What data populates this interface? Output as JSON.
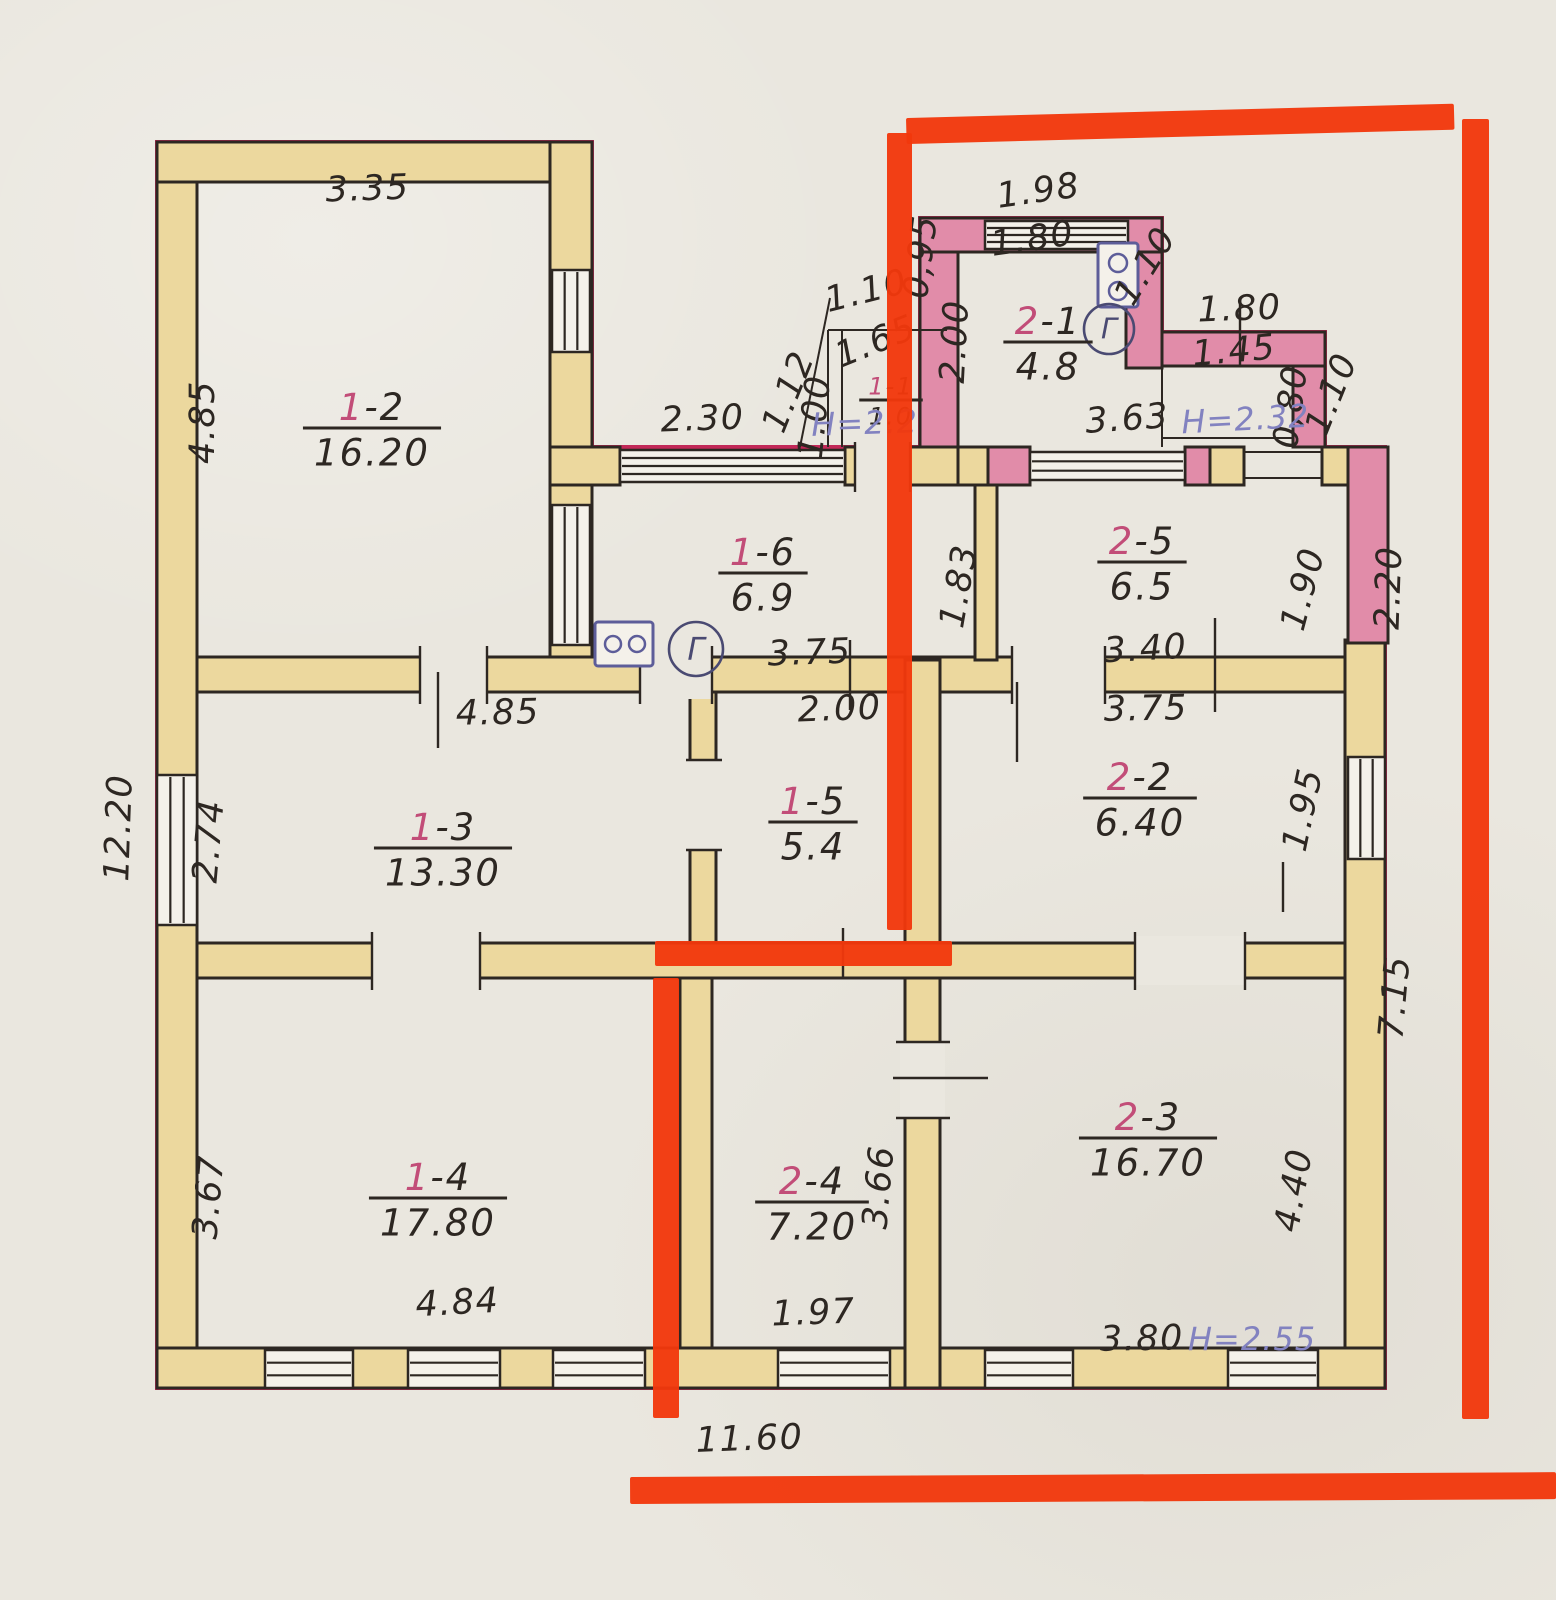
{
  "document": {
    "type": "hand-drawn floor plan (technical passport sheet)",
    "height_notes_color": "#8282c0",
    "marker_color": "#f1380c"
  },
  "palette": {
    "paper": "#eae7df",
    "wall_tan": "#ecd89e",
    "wall_pink": "#e18ca9",
    "ink": "#2d2722",
    "crimson": "#c22858",
    "marker": "#f1380c",
    "purple": "#8282c0",
    "blue": "#5d5d99",
    "meter_ink": "#4a4a72",
    "room_num_red": "#c24d78",
    "white": "#f4f1ea"
  },
  "rooms": [
    {
      "num": "1-2",
      "area": "16.20",
      "x": 372,
      "y": 428
    },
    {
      "num": "1-6",
      "area": "6.9",
      "x": 763,
      "y": 573
    },
    {
      "num": "2-1",
      "area": "4.8",
      "x": 1048,
      "y": 342
    },
    {
      "num": "2-5",
      "area": "6.5",
      "x": 1142,
      "y": 562
    },
    {
      "num": "1-3",
      "area": "13.30",
      "x": 443,
      "y": 848
    },
    {
      "num": "1-5",
      "area": "5.4",
      "x": 813,
      "y": 822
    },
    {
      "num": "2-2",
      "area": "6.40",
      "x": 1140,
      "y": 798
    },
    {
      "num": "1-4",
      "area": "17.80",
      "x": 438,
      "y": 1198
    },
    {
      "num": "2-4",
      "area": "7.20",
      "x": 812,
      "y": 1202
    },
    {
      "num": "2-3",
      "area": "16.70",
      "x": 1148,
      "y": 1138
    },
    {
      "num": "1-1",
      "area": "1.0",
      "x": 891,
      "y": 400,
      "s": 24
    }
  ],
  "dims": [
    {
      "t": "3.35",
      "x": 368,
      "y": 200,
      "r": -2
    },
    {
      "t": "4.85",
      "x": 214,
      "y": 422,
      "r": -90
    },
    {
      "t": "2.30",
      "x": 703,
      "y": 430,
      "r": -2
    },
    {
      "t": "1.98",
      "x": 1040,
      "y": 202,
      "r": -8
    },
    {
      "t": "1.80",
      "x": 1034,
      "y": 250,
      "r": -8
    },
    {
      "t": "0,95",
      "x": 932,
      "y": 258,
      "r": -83
    },
    {
      "t": "2.00",
      "x": 966,
      "y": 342,
      "r": -87
    },
    {
      "t": "1.10",
      "x": 1155,
      "y": 272,
      "r": -58
    },
    {
      "t": "1.80",
      "x": 1240,
      "y": 320,
      "r": -2
    },
    {
      "t": "1.45",
      "x": 1235,
      "y": 362,
      "r": -5
    },
    {
      "t": "0,80",
      "x": 1302,
      "y": 408,
      "r": -83
    },
    {
      "t": "1.10",
      "x": 1342,
      "y": 398,
      "r": -68
    },
    {
      "t": "3.63",
      "x": 1128,
      "y": 430,
      "r": -4
    },
    {
      "t": "1.12",
      "x": 799,
      "y": 396,
      "r": -68
    },
    {
      "t": "1.00",
      "x": 826,
      "y": 418,
      "r": -84
    },
    {
      "t": "1.65",
      "x": 880,
      "y": 352,
      "r": -22
    },
    {
      "t": "1.10",
      "x": 869,
      "y": 302,
      "r": -14
    },
    {
      "t": "1.83",
      "x": 970,
      "y": 588,
      "r": -80
    },
    {
      "t": "1.90",
      "x": 1314,
      "y": 592,
      "r": -75
    },
    {
      "t": "2.20",
      "x": 1400,
      "y": 588,
      "r": -88
    },
    {
      "t": "3.40",
      "x": 1146,
      "y": 660,
      "r": -3
    },
    {
      "t": "3.75",
      "x": 810,
      "y": 664,
      "r": -2
    },
    {
      "t": "12.20",
      "x": 130,
      "y": 828,
      "r": -88
    },
    {
      "t": "2.74",
      "x": 220,
      "y": 842,
      "r": -85
    },
    {
      "t": "4.85",
      "x": 498,
      "y": 724,
      "r": -1
    },
    {
      "t": "2.00",
      "x": 840,
      "y": 720,
      "r": -2
    },
    {
      "t": "3.75",
      "x": 1146,
      "y": 720,
      "r": -1
    },
    {
      "t": "1.95",
      "x": 1314,
      "y": 812,
      "r": -78
    },
    {
      "t": "3.67",
      "x": 220,
      "y": 1198,
      "r": -85
    },
    {
      "t": "3.66",
      "x": 890,
      "y": 1188,
      "r": -85
    },
    {
      "t": "4.40",
      "x": 1305,
      "y": 1192,
      "r": -80
    },
    {
      "t": "7.15",
      "x": 1406,
      "y": 998,
      "r": -85
    },
    {
      "t": "4.84",
      "x": 458,
      "y": 1314,
      "r": -3
    },
    {
      "t": "1.97",
      "x": 814,
      "y": 1324,
      "r": -2
    },
    {
      "t": "3.80",
      "x": 1142,
      "y": 1350,
      "r": -1
    },
    {
      "t": "11.60",
      "x": 750,
      "y": 1450,
      "r": -2
    }
  ],
  "notes": [
    {
      "t": "Н=2.2",
      "x": 865,
      "y": 434,
      "r": -2
    },
    {
      "t": "Н=2.32",
      "x": 1246,
      "y": 430,
      "r": -3
    },
    {
      "t": "Н=2.55",
      "x": 1252,
      "y": 1350,
      "r": 0
    }
  ],
  "marker_segments": [
    {
      "x": 906,
      "y": 118,
      "w": 548,
      "h": 26,
      "rot": -1.5
    },
    {
      "x": 1462,
      "y": 119,
      "w": 27,
      "h": 1300,
      "rot": 0
    },
    {
      "x": 887,
      "y": 133,
      "w": 25,
      "h": 797,
      "rot": 0
    },
    {
      "x": 655,
      "y": 941,
      "w": 297,
      "h": 25,
      "rot": 0
    },
    {
      "x": 653,
      "y": 978,
      "w": 26,
      "h": 440,
      "rot": 0
    },
    {
      "x": 630,
      "y": 1477,
      "w": 926,
      "h": 27,
      "rot": -0.3
    }
  ],
  "geometry": {
    "outline": "M157 1388 L157 142 L592 142 L592 447 L920 447 L920 218 L1162 218 L1162 332 L1325 332 L1325 447 L1385 447 L1385 1388 Z",
    "walls": [
      {
        "x": 157,
        "y": 142,
        "w": 40,
        "h": 1246,
        "f": "t"
      },
      {
        "x": 157,
        "y": 142,
        "w": 435,
        "h": 40,
        "f": "t"
      },
      {
        "x": 550,
        "y": 142,
        "w": 42,
        "h": 548,
        "f": "t"
      },
      {
        "x": 550,
        "y": 447,
        "w": 70,
        "h": 38,
        "f": "t"
      },
      {
        "x": 845,
        "y": 447,
        "w": 113,
        "h": 38,
        "f": "t"
      },
      {
        "x": 958,
        "y": 447,
        "w": 30,
        "h": 38,
        "f": "t"
      },
      {
        "x": 988,
        "y": 447,
        "w": 42,
        "h": 38,
        "f": "p"
      },
      {
        "x": 1185,
        "y": 447,
        "w": 25,
        "h": 38,
        "f": "p"
      },
      {
        "x": 1210,
        "y": 447,
        "w": 34,
        "h": 38,
        "f": "t"
      },
      {
        "x": 1322,
        "y": 447,
        "w": 63,
        "h": 38,
        "f": "t"
      },
      {
        "x": 1345,
        "y": 640,
        "w": 40,
        "h": 748,
        "f": "t"
      },
      {
        "x": 1348,
        "y": 447,
        "w": 40,
        "h": 196,
        "f": "p"
      },
      {
        "x": 157,
        "y": 1348,
        "w": 1228,
        "h": 40,
        "f": "t"
      },
      {
        "x": 197,
        "y": 657,
        "w": 1148,
        "h": 35,
        "f": "t"
      },
      {
        "x": 975,
        "y": 485,
        "w": 22,
        "h": 175,
        "f": "t"
      },
      {
        "x": 690,
        "y": 692,
        "w": 26,
        "h": 253,
        "f": "t"
      },
      {
        "x": 905,
        "y": 660,
        "w": 35,
        "h": 728,
        "f": "t"
      },
      {
        "x": 680,
        "y": 975,
        "w": 32,
        "h": 373,
        "f": "t"
      },
      {
        "x": 197,
        "y": 943,
        "w": 1148,
        "h": 35,
        "f": "t"
      },
      {
        "x": 920,
        "y": 218,
        "w": 38,
        "h": 229,
        "f": "p"
      },
      {
        "x": 920,
        "y": 218,
        "w": 242,
        "h": 34,
        "f": "p"
      },
      {
        "x": 1126,
        "y": 252,
        "w": 36,
        "h": 116,
        "f": "p"
      },
      {
        "x": 1162,
        "y": 332,
        "w": 163,
        "h": 34,
        "f": "p"
      },
      {
        "x": 1293,
        "y": 366,
        "w": 32,
        "h": 81,
        "f": "p"
      }
    ],
    "gap_covers": [
      {
        "x": 420,
        "y": 650,
        "w": 67,
        "h": 49
      },
      {
        "x": 640,
        "y": 650,
        "w": 72,
        "h": 49
      },
      {
        "x": 1012,
        "y": 650,
        "w": 93,
        "h": 49
      },
      {
        "x": 372,
        "y": 936,
        "w": 108,
        "h": 49
      },
      {
        "x": 1135,
        "y": 936,
        "w": 110,
        "h": 49
      },
      {
        "x": 900,
        "y": 1042,
        "w": 45,
        "h": 76
      },
      {
        "x": 683,
        "y": 760,
        "w": 40,
        "h": 90
      },
      {
        "x": 855,
        "y": 440,
        "w": 55,
        "h": 52
      }
    ],
    "windows": [
      {
        "x": 157,
        "y": 775,
        "w": 40,
        "h": 150,
        "dir": "v",
        "n": 2
      },
      {
        "x": 552,
        "y": 270,
        "w": 38,
        "h": 82,
        "dir": "v",
        "n": 2
      },
      {
        "x": 552,
        "y": 505,
        "w": 38,
        "h": 140,
        "dir": "v",
        "n": 2
      },
      {
        "x": 620,
        "y": 450,
        "w": 225,
        "h": 32,
        "dir": "h",
        "n": 3
      },
      {
        "x": 985,
        "y": 221,
        "w": 143,
        "h": 28,
        "dir": "h",
        "n": 3
      },
      {
        "x": 1030,
        "y": 452,
        "w": 155,
        "h": 28,
        "dir": "h",
        "n": 2
      },
      {
        "x": 1348,
        "y": 757,
        "w": 37,
        "h": 102,
        "dir": "v",
        "n": 2
      },
      {
        "x": 265,
        "y": 1350,
        "w": 88,
        "h": 38,
        "dir": "h",
        "n": 2
      },
      {
        "x": 408,
        "y": 1350,
        "w": 92,
        "h": 38,
        "dir": "h",
        "n": 2
      },
      {
        "x": 553,
        "y": 1350,
        "w": 92,
        "h": 38,
        "dir": "h",
        "n": 2
      },
      {
        "x": 778,
        "y": 1350,
        "w": 112,
        "h": 38,
        "dir": "h",
        "n": 2
      },
      {
        "x": 985,
        "y": 1350,
        "w": 88,
        "h": 38,
        "dir": "h",
        "n": 2
      },
      {
        "x": 1228,
        "y": 1350,
        "w": 90,
        "h": 38,
        "dir": "h",
        "n": 2
      }
    ],
    "thin_lines": [
      {
        "x1": 828,
        "y1": 330,
        "x2": 828,
        "y2": 447
      },
      {
        "x1": 842,
        "y1": 330,
        "x2": 842,
        "y2": 447
      },
      {
        "x1": 828,
        "y1": 330,
        "x2": 947,
        "y2": 330
      },
      {
        "x1": 800,
        "y1": 447,
        "x2": 830,
        "y2": 298
      },
      {
        "x1": 1162,
        "y1": 368,
        "x2": 1162,
        "y2": 447
      },
      {
        "x1": 1162,
        "y1": 438,
        "x2": 1293,
        "y2": 438
      },
      {
        "x1": 1244,
        "y1": 452,
        "x2": 1322,
        "y2": 452
      },
      {
        "x1": 1244,
        "y1": 478,
        "x2": 1322,
        "y2": 478
      }
    ],
    "ticks": [
      {
        "x1": 420,
        "y1": 646,
        "x2": 420,
        "y2": 704
      },
      {
        "x1": 487,
        "y1": 646,
        "x2": 487,
        "y2": 704
      },
      {
        "x1": 640,
        "y1": 646,
        "x2": 640,
        "y2": 704
      },
      {
        "x1": 712,
        "y1": 646,
        "x2": 712,
        "y2": 704
      },
      {
        "x1": 1012,
        "y1": 646,
        "x2": 1012,
        "y2": 704
      },
      {
        "x1": 1105,
        "y1": 646,
        "x2": 1105,
        "y2": 704
      },
      {
        "x1": 372,
        "y1": 932,
        "x2": 372,
        "y2": 990
      },
      {
        "x1": 480,
        "y1": 932,
        "x2": 480,
        "y2": 990
      },
      {
        "x1": 1135,
        "y1": 932,
        "x2": 1135,
        "y2": 990
      },
      {
        "x1": 1245,
        "y1": 932,
        "x2": 1245,
        "y2": 990
      },
      {
        "x1": 896,
        "y1": 1042,
        "x2": 950,
        "y2": 1042
      },
      {
        "x1": 896,
        "y1": 1118,
        "x2": 950,
        "y2": 1118
      },
      {
        "x1": 893,
        "y1": 1078,
        "x2": 988,
        "y2": 1078
      },
      {
        "x1": 686,
        "y1": 760,
        "x2": 722,
        "y2": 760
      },
      {
        "x1": 686,
        "y1": 850,
        "x2": 722,
        "y2": 850
      },
      {
        "x1": 855,
        "y1": 442,
        "x2": 855,
        "y2": 492
      },
      {
        "x1": 910,
        "y1": 442,
        "x2": 910,
        "y2": 492
      },
      {
        "x1": 438,
        "y1": 672,
        "x2": 438,
        "y2": 748
      },
      {
        "x1": 850,
        "y1": 640,
        "x2": 850,
        "y2": 710
      },
      {
        "x1": 1215,
        "y1": 618,
        "x2": 1215,
        "y2": 712
      },
      {
        "x1": 1017,
        "y1": 682,
        "x2": 1017,
        "y2": 762
      },
      {
        "x1": 1240,
        "y1": 300,
        "x2": 1240,
        "y2": 365
      },
      {
        "x1": 1283,
        "y1": 862,
        "x2": 1283,
        "y2": 912
      },
      {
        "x1": 843,
        "y1": 928,
        "x2": 843,
        "y2": 978
      }
    ]
  },
  "symbols": {
    "gas_meters": [
      {
        "x": 696,
        "y": 649,
        "r": 27,
        "label": "Г"
      },
      {
        "x": 1109,
        "y": 329,
        "r": 25,
        "label": "Г"
      }
    ],
    "stoves": [
      {
        "x": 595,
        "y": 622,
        "w": 58,
        "h": 44,
        "burners": [
          [
            613,
            644
          ],
          [
            637,
            644
          ]
        ],
        "br": 8
      },
      {
        "x": 1098,
        "y": 243,
        "w": 40,
        "h": 64,
        "burners": [
          [
            1118,
            263
          ],
          [
            1118,
            291
          ]
        ],
        "br": 9
      }
    ]
  }
}
